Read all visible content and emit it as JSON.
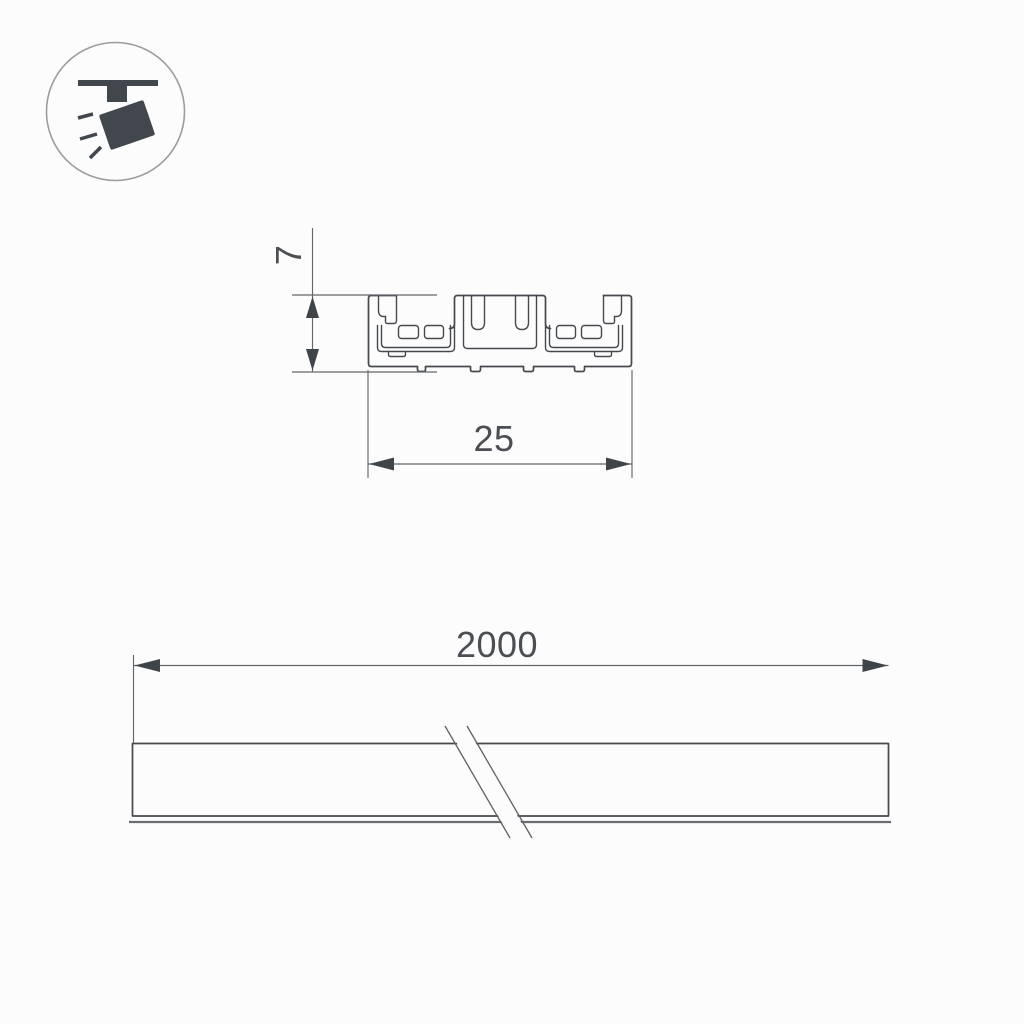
{
  "drawing": {
    "type": "technical-dimension-drawing",
    "background": "#fcfcfc",
    "line_color": "#45494e",
    "dim_line_color": "#63676c",
    "arrow_color": "#3f4449",
    "text_color": "#4b4f54",
    "icon": {
      "name": "ceiling-track-spotlight-icon",
      "fill": "#42474d",
      "ring_color": "#9a9da0"
    },
    "views": {
      "cross_section": {
        "height_label": "7",
        "width_label": "25"
      },
      "side": {
        "length_label": "2000"
      }
    }
  }
}
